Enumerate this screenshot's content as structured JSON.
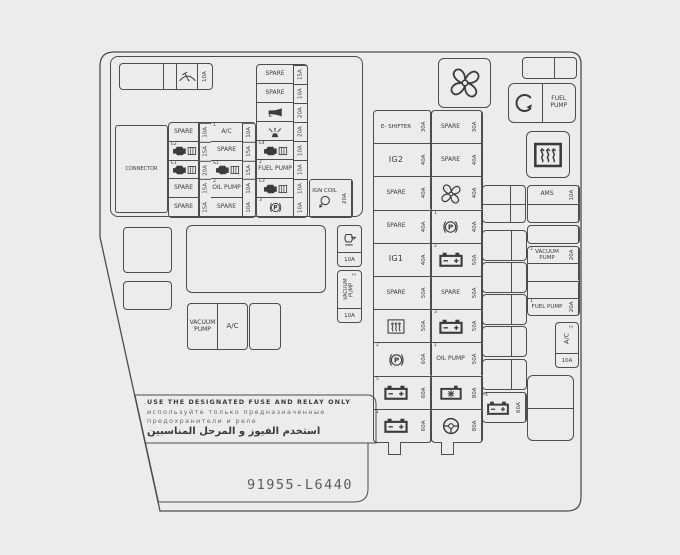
{
  "colors": {
    "bg": "#ececec",
    "ink": "#3b3b3b",
    "line": "#4d4d4d"
  },
  "part_number": "91955-L6440",
  "warning": {
    "en": "USE THE DESIGNATED FUSE AND RELAY ONLY",
    "ru1": "используйте только предназначенные",
    "ru2": "предохранители и реле",
    "ar": "استخدم الفيوز و المرحل المناسبين"
  },
  "top_panel": {
    "connector": "CONNECTOR",
    "strip": {
      "icon": "wiper-icon",
      "amp": "10A"
    },
    "col1": [
      {
        "label": "SPARE",
        "amp": "10A"
      },
      {
        "sup": "E2",
        "icon": "engine-icon",
        "amp": "15A"
      },
      {
        "sup": "E1",
        "icon": "engine-icon",
        "amp": "20A"
      },
      {
        "label": "SPARE",
        "amp": "15A"
      },
      {
        "label": "SPARE",
        "amp": "15A"
      }
    ],
    "col2": [
      {
        "sup": "1",
        "label": "A/C",
        "amp": "10A"
      },
      {
        "label": "SPARE",
        "amp": "15A"
      },
      {
        "sup": "S1",
        "icon": "engine-icon",
        "amp": "15A"
      },
      {
        "sup": "2",
        "label": "OIL PUMP",
        "amp": "10A"
      },
      {
        "label": "SPARE",
        "amp": "10A"
      }
    ],
    "col3": [
      {
        "label": "SPARE",
        "amp": "15A"
      },
      {
        "label": "SPARE",
        "amp": "10A"
      },
      {
        "icon": "horn-icon",
        "amp": "20A"
      },
      {
        "icon": "washer-spray-icon",
        "amp": "20A"
      },
      {
        "sup": "E4",
        "icon": "engine-icon",
        "amp": "10A"
      },
      {
        "sup": "2",
        "label": "FUEL PUMP",
        "amp": "10A"
      },
      {
        "sup": "E3",
        "icon": "engine-icon",
        "amp": "10A"
      },
      {
        "sup": "3",
        "icon": "park-brake-icon",
        "amp": "10A"
      }
    ],
    "ign_coil": {
      "label": "IGN COIL",
      "icon": "ignition-coil-icon",
      "amp": "20A"
    }
  },
  "center": {
    "col_a": [
      {
        "label": "E- SHIFTER",
        "amp": "30A"
      },
      {
        "label": "IG2",
        "amp": "40A"
      },
      {
        "label": "SPARE",
        "amp": "40A"
      },
      {
        "label": "SPARE",
        "amp": "40A"
      },
      {
        "label": "IG1",
        "amp": "40A"
      },
      {
        "label": "SPARE",
        "amp": "50A"
      },
      {
        "icon": "heater-waves-icon",
        "amp": "50A"
      },
      {
        "sup": "2",
        "icon": "park-brake-icon",
        "amp": "60A"
      },
      {
        "sup": "5",
        "icon": "battery-icon",
        "amp": "60A"
      },
      {
        "sup": "1",
        "icon": "battery-icon",
        "amp": "60A"
      }
    ],
    "col_b": [
      {
        "label": "SPARE",
        "amp": "30A"
      },
      {
        "label": "SPARE",
        "amp": "40A"
      },
      {
        "icon": "fan-icon",
        "amp": "40A"
      },
      {
        "sup": "1",
        "icon": "park-brake-icon",
        "amp": "40A"
      },
      {
        "sup": "2",
        "icon": "battery-icon",
        "amp": "50A"
      },
      {
        "label": "SPARE",
        "amp": "50A"
      },
      {
        "sup": "3",
        "icon": "battery-icon",
        "amp": "50A"
      },
      {
        "sup": "1",
        "label": "OIL PUMP",
        "amp": "50A"
      },
      {
        "icon": "starred-battery-icon",
        "amp": "80A"
      },
      {
        "icon": "steering-icon",
        "amp": "80A"
      }
    ]
  },
  "mid_left": {
    "vacuum_pump": "VACUUM PUMP",
    "ac": "A/C"
  },
  "side_fuses": {
    "f1": {
      "icon": "coolant-pump-icon",
      "amp": "10A"
    },
    "f2": {
      "sup": "2",
      "label": "VACUUM PUMP",
      "amp": "10A"
    }
  },
  "right_side": {
    "fan_relay_icon": "fan-icon",
    "pump_relay": {
      "icon": "rotation-arrow-icon",
      "label": "FUEL PUMP"
    },
    "defroster_icon": "rear-defrost-icon",
    "ams": {
      "label": "AMS",
      "amp": "10A"
    },
    "vacuum_pump": {
      "sup": "1",
      "label": "VACUUM PUMP",
      "amp": "20A"
    },
    "fuel_pump": {
      "sup": "1",
      "label": "FUEL PUMP",
      "amp": "20A"
    },
    "ac": {
      "sup": "2",
      "label": "A/C",
      "amp": "10A"
    },
    "battery4": {
      "sup": "4",
      "icon": "battery-icon",
      "amp": "60A"
    }
  }
}
